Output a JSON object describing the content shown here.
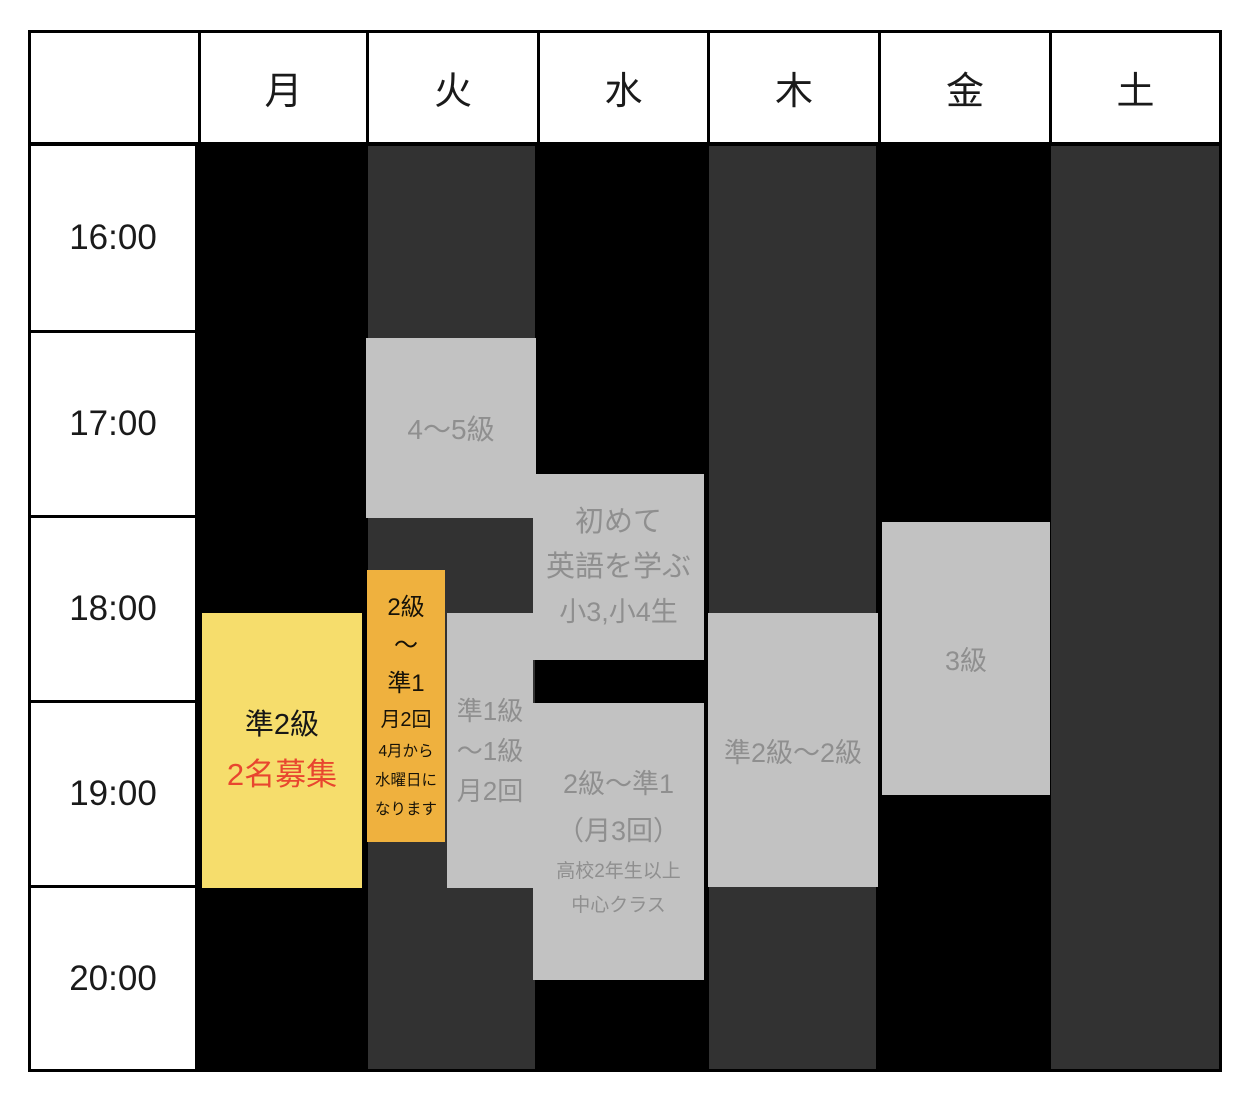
{
  "days": [
    "月",
    "火",
    "水",
    "木",
    "金",
    "土"
  ],
  "times": [
    "16:00",
    "17:00",
    "18:00",
    "19:00",
    "20:00"
  ],
  "colors": {
    "column_black": "#000000",
    "column_dark": "#323232",
    "block_gray": "#C2C2C2",
    "block_yellow": "#F6DD6C",
    "block_orange": "#EFB13E",
    "text_gray": "#8F8F8F",
    "text_red": "#E8462F"
  },
  "events": [
    {
      "day": "月",
      "name": "pre2-recruiting",
      "lines": [
        "準2級",
        "2名募集"
      ]
    },
    {
      "day": "火",
      "name": "grade4-5",
      "lines": [
        "4〜5級"
      ]
    },
    {
      "day": "火",
      "name": "grade2-pre1-moving",
      "lines": [
        "2級",
        "〜",
        "準1",
        "月2回",
        "4月から",
        "水曜日に",
        "なります"
      ]
    },
    {
      "day": "火",
      "name": "pre1-grade1",
      "lines": [
        "準1級",
        "〜1級",
        "月2回"
      ]
    },
    {
      "day": "水",
      "name": "beginner-elementary",
      "lines": [
        "初めて",
        "英語を学ぶ",
        "小3,小4生"
      ]
    },
    {
      "day": "水",
      "name": "grade2-pre1",
      "lines": [
        "2級〜準1",
        "（月3回）",
        "高校2年生以上",
        "中心クラス"
      ]
    },
    {
      "day": "木",
      "name": "pre2-grade2",
      "lines": [
        "準2級〜2級"
      ]
    },
    {
      "day": "金",
      "name": "grade3",
      "lines": [
        "3級"
      ]
    }
  ]
}
